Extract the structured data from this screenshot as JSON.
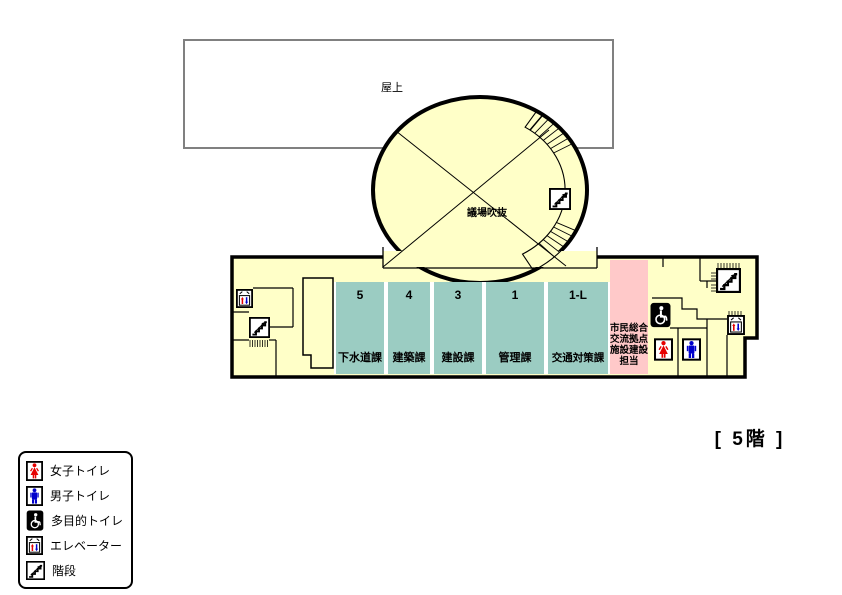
{
  "rooftop_label": "屋上",
  "atrium_label": "議場吹抜",
  "floor_label": "[ 5階 ]",
  "sections": [
    {
      "number": "5",
      "name": "下水道課"
    },
    {
      "number": "4",
      "name": "建築課"
    },
    {
      "number": "3",
      "name": "建設課"
    },
    {
      "number": "1",
      "name": "管理課"
    },
    {
      "number": "1-L",
      "name": "交通対策課"
    }
  ],
  "pink_section": {
    "name": "市民総合交流拠点施設建設担当",
    "lines": [
      "市民総合",
      "交流拠点",
      "施設建設",
      "担当"
    ]
  },
  "legend": {
    "items": [
      {
        "icon": "female-toilet-icon",
        "label": "女子トイレ"
      },
      {
        "icon": "male-toilet-icon",
        "label": "男子トイレ"
      },
      {
        "icon": "accessible-toilet-icon",
        "label": "多目的トイレ"
      },
      {
        "icon": "elevator-icon",
        "label": "エレベーター"
      },
      {
        "icon": "stairs-icon",
        "label": "階段"
      }
    ]
  },
  "colors": {
    "floor": "#FFFFC8",
    "department": "#9BCCC2",
    "construction_office": "#FFC9C9",
    "female": "#E60000",
    "male": "#0000CC",
    "outline": "#000000",
    "rooftop_border": "#808080",
    "white": "#FFFFFF"
  }
}
